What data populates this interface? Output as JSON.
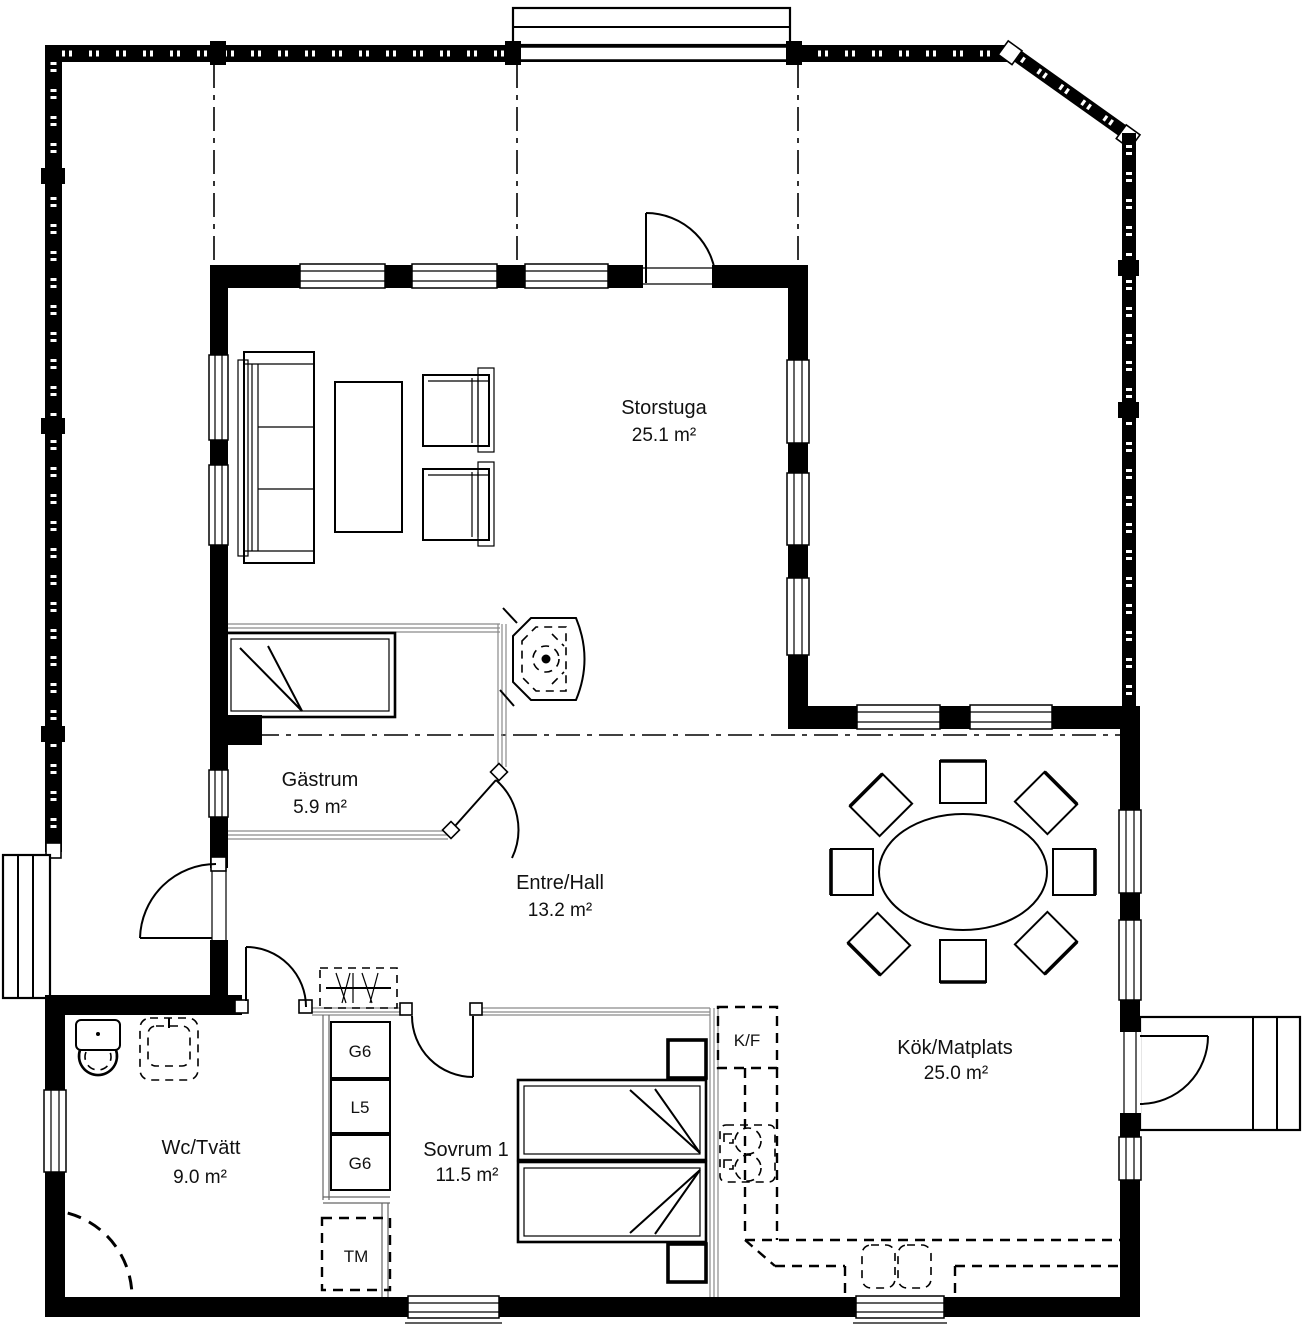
{
  "plan": {
    "rooms": {
      "storstuga": {
        "name": "Storstuga",
        "area": "25.1 m²"
      },
      "gastrum": {
        "name": "Gästrum",
        "area": "5.9 m²"
      },
      "entre_hall": {
        "name": "Entre/Hall",
        "area": "13.2 m²"
      },
      "kok_matplats": {
        "name": "Kök/Matplats",
        "area": "25.0 m²"
      },
      "wc_tvatt": {
        "name": "Wc/Tvätt",
        "area": "9.0 m²"
      },
      "sovrum1": {
        "name": "Sovrum 1",
        "area": "11.5 m²"
      }
    },
    "fixtures": {
      "fridge_freezer": "K/F",
      "cabinet_top": "G6",
      "cabinet_mid": "L5",
      "cabinet_bottom": "G6",
      "washing_machine": "TM"
    },
    "colors": {
      "line": "#000000",
      "background": "#ffffff",
      "glass_partition": "#8a8a8a"
    }
  }
}
